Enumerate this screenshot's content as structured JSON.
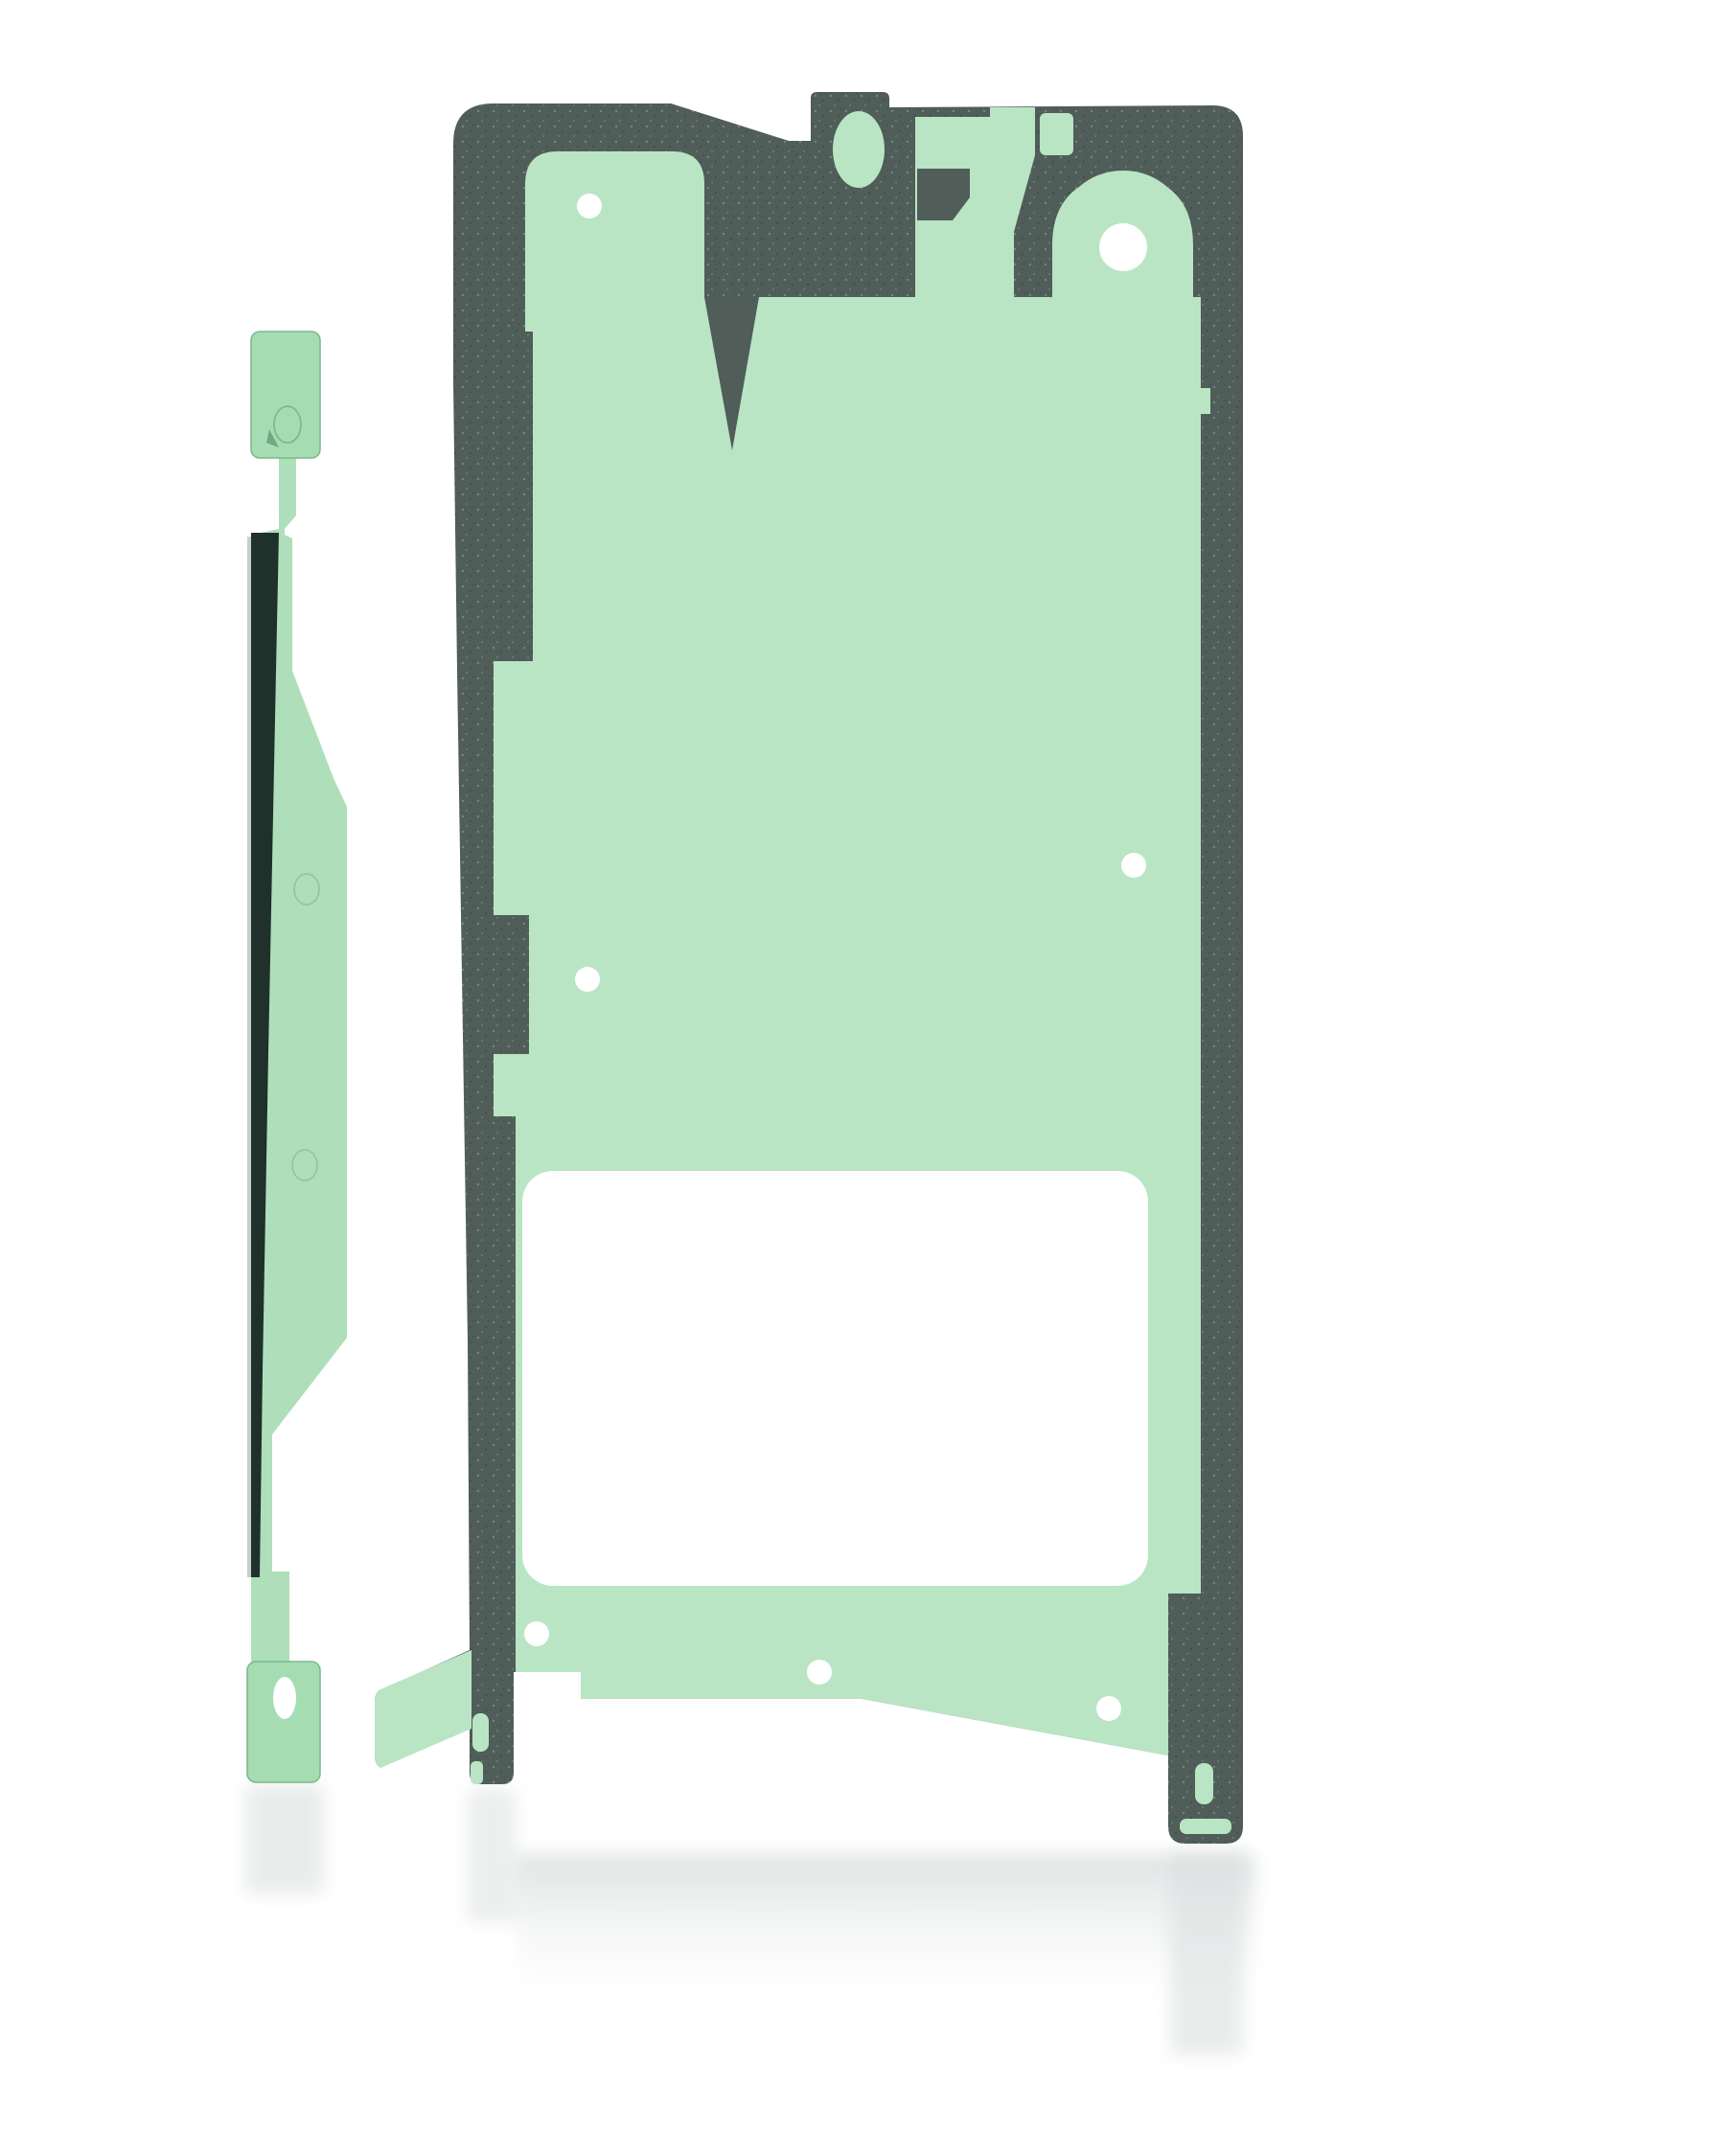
{
  "image": {
    "type": "product-photo",
    "subject": "phone screen adhesive tape kit, two die-cut green pieces on white background",
    "background_color": "#ffffff"
  },
  "main_piece": {
    "name": "display-adhesive-sheet",
    "backing_color": "#505d59",
    "liner_color": "#b9e5c4",
    "cutout_color": "#ffffff",
    "texture_opacity": "0.5"
  },
  "strip_piece": {
    "name": "side-adhesive-strip",
    "film_color": "#aedfba",
    "tab_color": "#a5dcb2",
    "edge_color": "#20302a",
    "outline_color": "#7cba8f",
    "emboss_color": "#8fc9a0",
    "highlight_color": "#c6d0cb",
    "hole_color": "#ffffff"
  },
  "reflection": {
    "color": "#d9dddd"
  }
}
